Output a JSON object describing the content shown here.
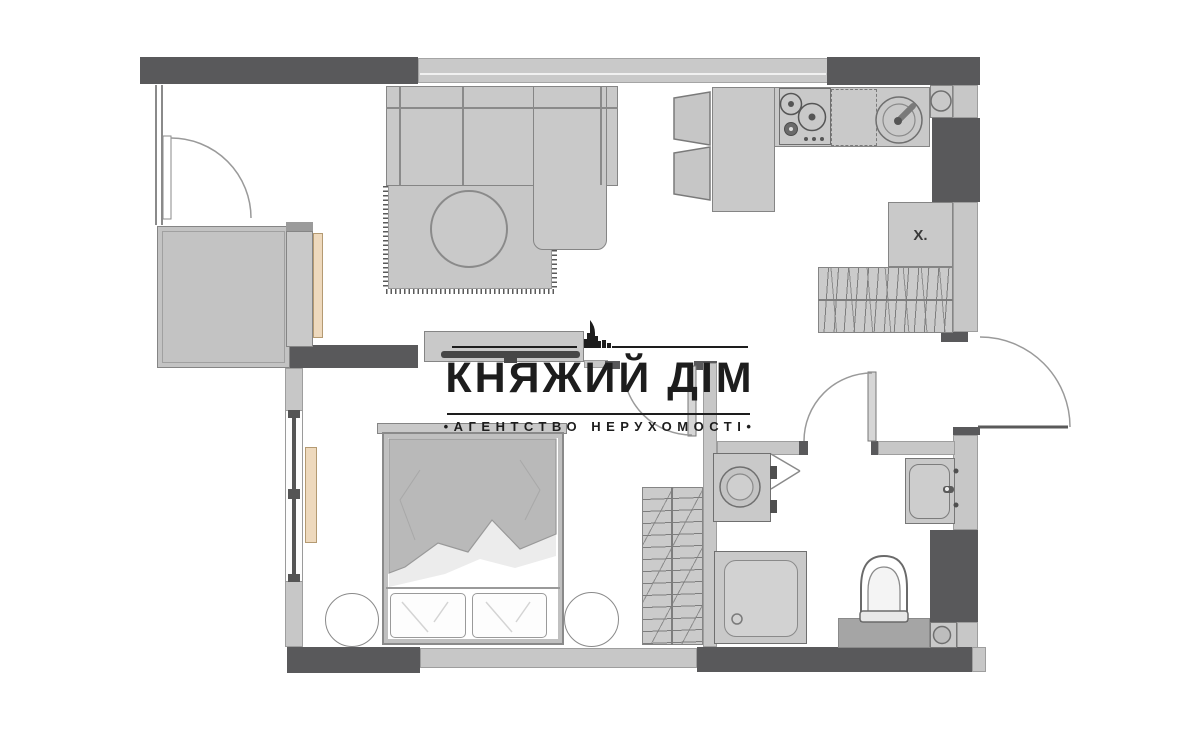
{
  "watermark": {
    "title": "КНЯЖИЙ ДІМ",
    "subtitle": "•АГЕНТСТВО НЕРУХОМОСТІ•",
    "color": "#1d1d1d"
  },
  "plan": {
    "fridge_label": "Х."
  },
  "colors": {
    "background": "#ffffff",
    "wall_dark": "#59595b",
    "wall_light": "#c7c7c7",
    "furniture_fill": "#c9c9c9",
    "furniture_stroke": "#858585",
    "accent_wood": "#eed9bd",
    "hatch_line": "#7d7d7d",
    "watermark_black": "#1d1d1d"
  }
}
